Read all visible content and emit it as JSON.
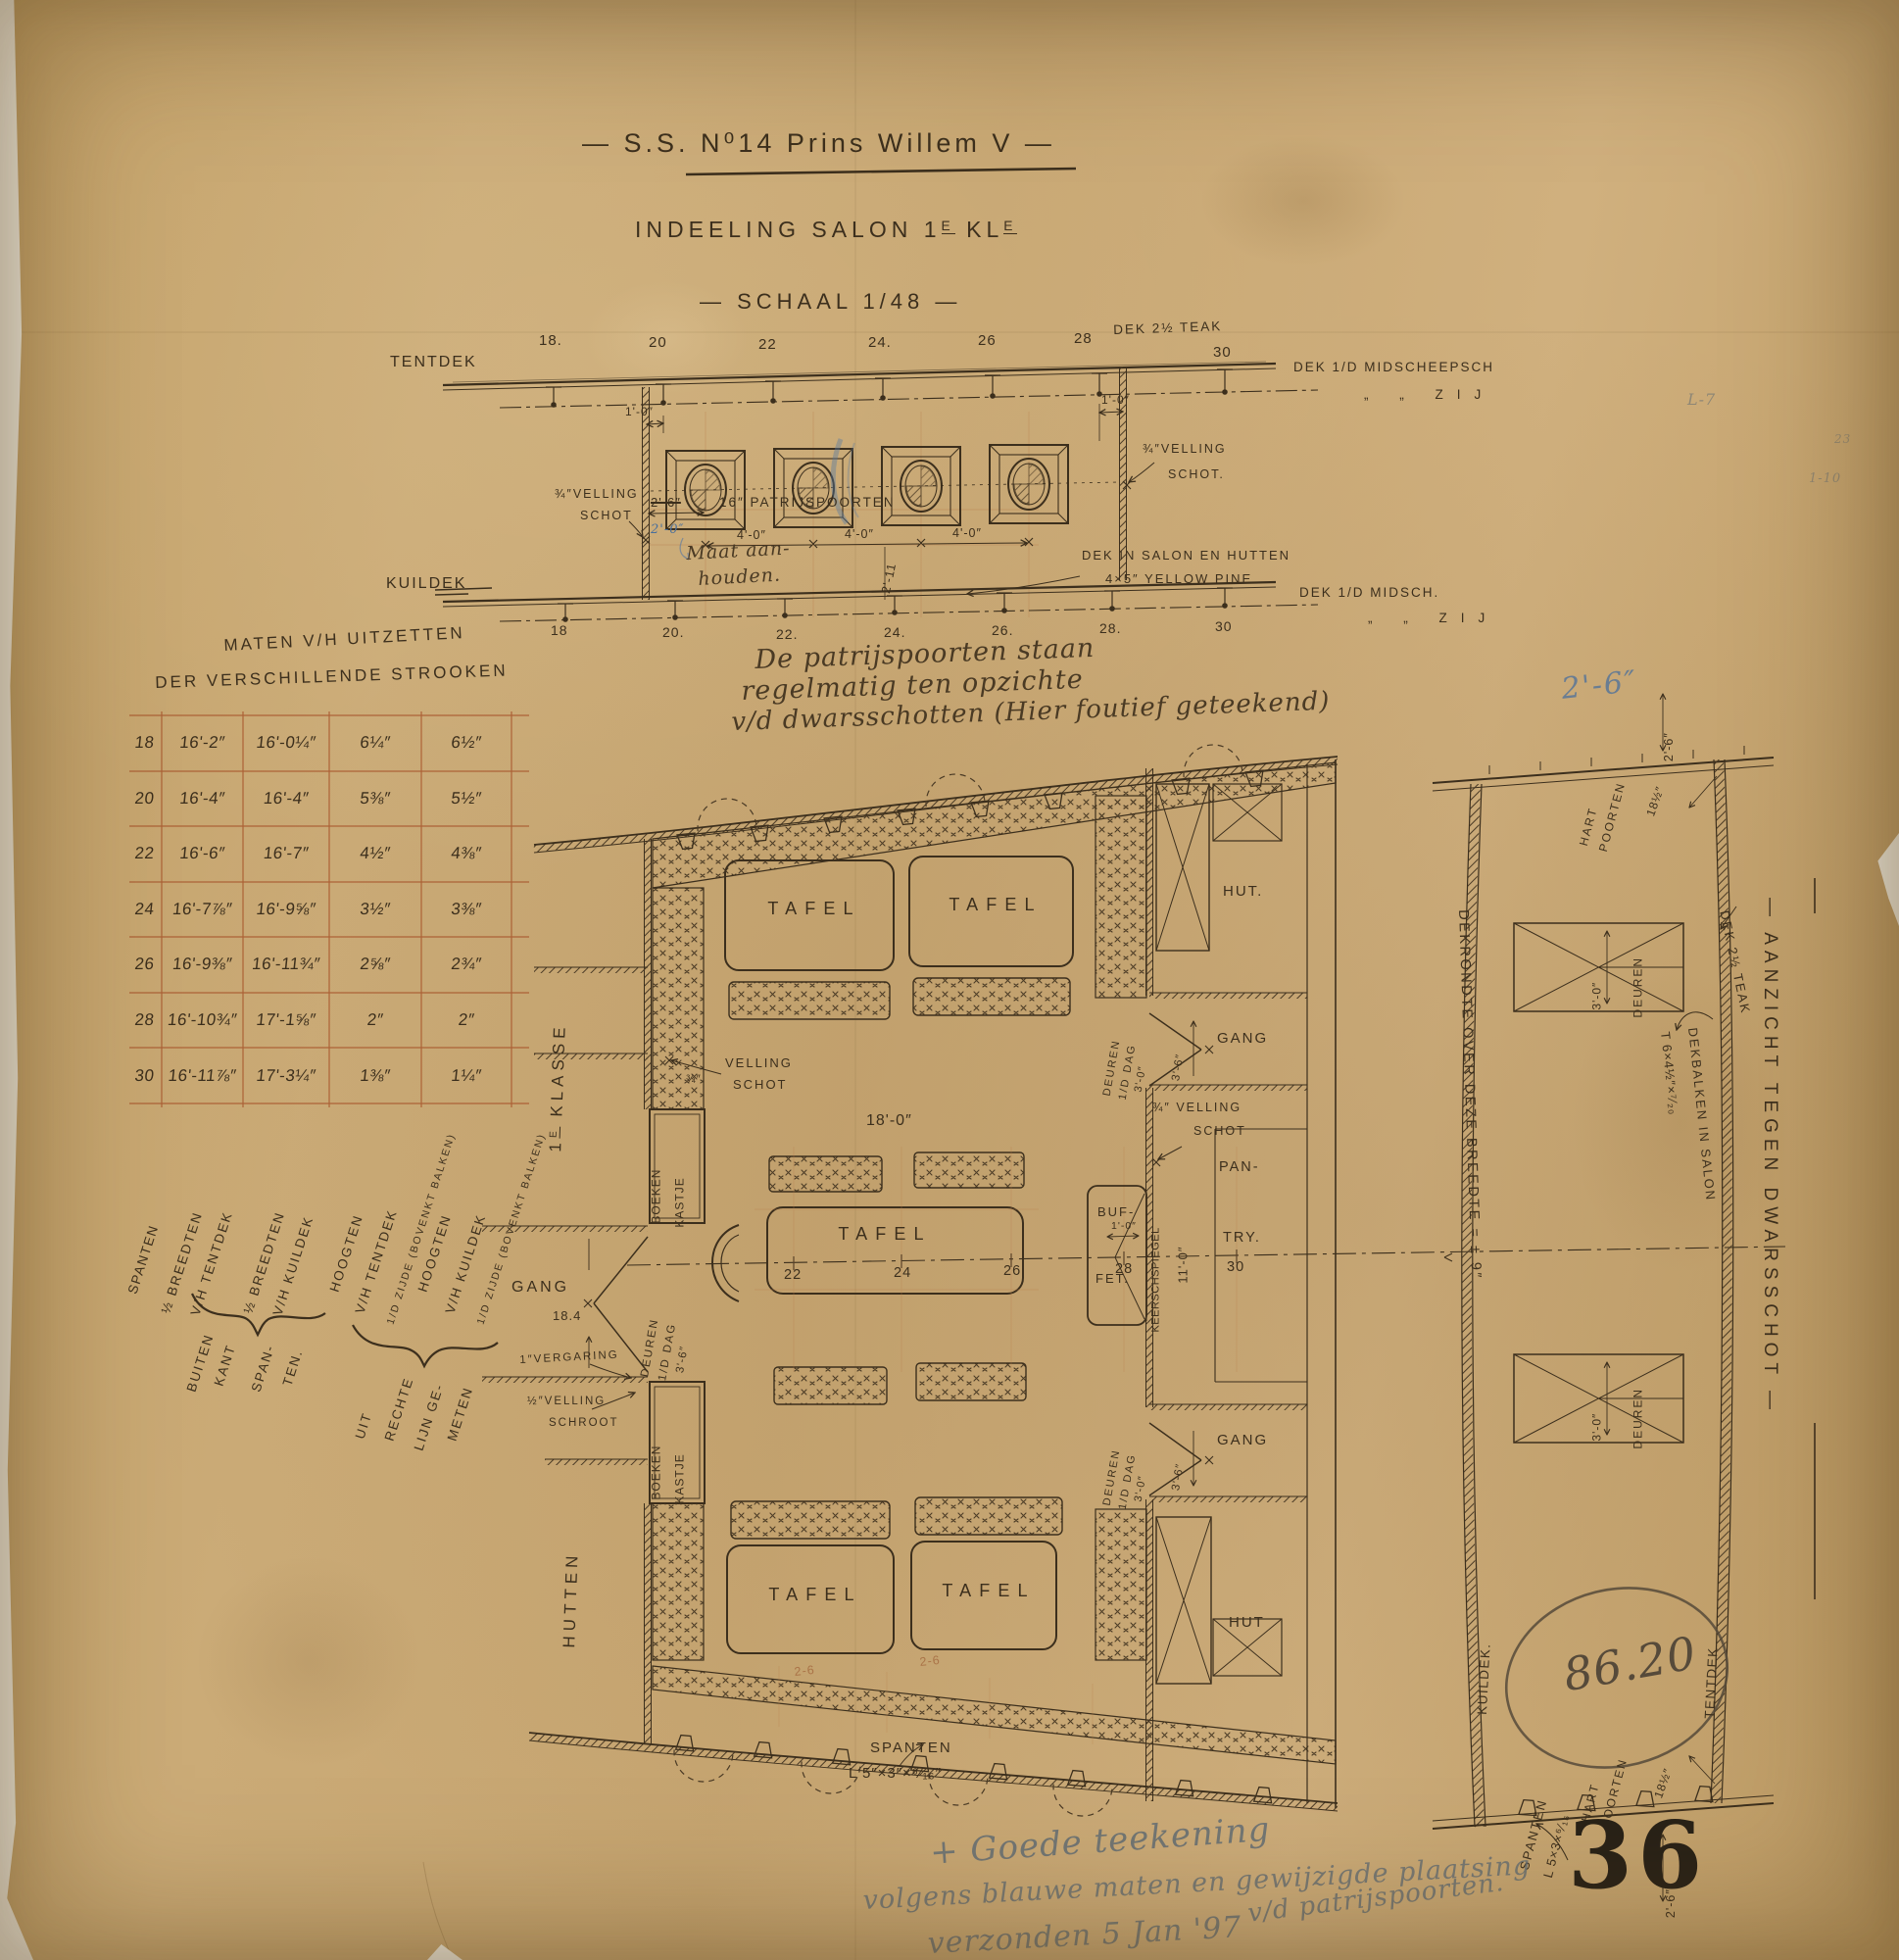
{
  "title": {
    "main": "— S.S. N⁰14 Prins Willem V —",
    "sub_pre": "INDEELING SALON 1",
    "sub_sup1": "E",
    "sub_mid": " KL",
    "sub_sup2": "E",
    "scale": "— SCHAAL 1/48 —"
  },
  "upper": {
    "tentdek": "TENTDEK",
    "kuildek": "KUILDEK",
    "ft": [
      "18.",
      "20",
      "22",
      "24.",
      "26",
      "28",
      "30"
    ],
    "fb": [
      "18",
      "20.",
      "22.",
      "24.",
      "26.",
      "28.",
      "30"
    ],
    "dek_teak": "DEK 2½ TEAK",
    "midscheepsch": "DEK 1/D MIDSCHEEPSCH",
    "zij1": "„ „ ZIJ",
    "midsch": "DEK 1/D MIDSCH.",
    "zij2": "„ „ ZIJ",
    "d10": "1'-0″",
    "d10b": "1'-0″",
    "d26": "2'-6″",
    "d20": "2'-0″",
    "pp": "16″ PATRIJSPOORTEN",
    "d40a": "4'-0″",
    "d40b": "4'-0″",
    "d40c": "4'-0″",
    "maat1": "Maat aan-",
    "maat2": "houden.",
    "vl1": "¾″VELLING",
    "vl2": "SCHOT",
    "vr1": "¾″VELLING",
    "vr2": "SCHOT.",
    "ds1": "DEK IN SALON EN HUTTEN",
    "ds2": "4×5″ YELLOW PINE",
    "p211": "2'-11"
  },
  "note": {
    "l1": "De patrijspoorten staan",
    "l2": "regelmatig ten opzichte",
    "l3": "v/d dwarsschotten (Hier foutief geteekend)"
  },
  "table": {
    "h1": "MATEN V/H UITZETTEN",
    "h2": "DER VERSCHILLENDE STROOKEN",
    "rows": [
      [
        "18",
        "16'-2″",
        "16'-0¼″",
        "6¼″",
        "6½″"
      ],
      [
        "20",
        "16'-4″",
        "16'-4″",
        "5⅜″",
        "5½″"
      ],
      [
        "22",
        "16'-6″",
        "16'-7″",
        "4½″",
        "4⅜″"
      ],
      [
        "24",
        "16'-7⅞″",
        "16'-9⅝″",
        "3½″",
        "3⅜″"
      ],
      [
        "26",
        "16'-9⅜″",
        "16'-11¾″",
        "2⅝″",
        "2¾″"
      ],
      [
        "28",
        "16'-10¾″",
        "17'-1⅝″",
        "2″",
        "2″"
      ],
      [
        "30",
        "16'-11⅞″",
        "17'-3¼″",
        "1⅜″",
        "1¼″"
      ]
    ],
    "c0": "SPANTEN",
    "c1a": "½ BREEDTEN",
    "c1b": "V/H TENTDEK",
    "c2a": "½ BREEDTEN",
    "c2b": "V/H KUILDEK",
    "c3a": "HOOGTEN",
    "c3b": "V/H TENTDEK",
    "c3c": "1/D ZIJDE (BOVENKT BALKEN)",
    "c4a": "HOOGTEN",
    "c4b": "V/H KUILDEK",
    "c4c": "1/D ZIJDE (BOVENKT BALKEN)",
    "b1": [
      "BUITEN",
      "KANT",
      "SPAN-",
      "TEN."
    ],
    "b2": [
      "UIT",
      "RECHTE",
      "LIJN GE-",
      "METEN"
    ]
  },
  "plan": {
    "klasse_pre": "1",
    "klasse_sup": "E",
    "klasse_post": " KLASSE",
    "hutten": "HUTTEN",
    "gang": "GANG",
    "gang_dim": "18.4",
    "vs_frac": "¾″",
    "vs1": "VELLING",
    "vs2": "SCHOT",
    "boeken": "BOEKEN",
    "kastje": "KASTJE",
    "dl1": "DEUREN",
    "dl2": "1/D DAG",
    "dl3": "3'-6″",
    "verg": "1″VERGARING",
    "schroot1": "½″VELLING",
    "schroot2": "SCHROOT",
    "d180": "18'-0″",
    "tafel": "TAFEL",
    "cf": [
      "22",
      "24",
      "26",
      "28",
      "30"
    ],
    "buf": "BUF-",
    "fet": "FET.",
    "d10": "1'-0″",
    "spiegel": "KEERSCHSPIEGEL",
    "d110": "11'-0″",
    "pan": "PAN-",
    "try": "TRY.",
    "vr1": "¾″ VELLING",
    "vr2": "SCHOT",
    "hut1": "HUT.",
    "hut2": "HUT",
    "gang_r1": "GANG",
    "gang_r2": "GANG",
    "dr1": "DEUREN",
    "dr2": "1/D DAG",
    "dr3": "3'-0″",
    "d36": "3'-6″",
    "sp1": "SPANTEN",
    "sp2": "L 5″×3″×⁶⁄₁₆″",
    "p26": "2-6"
  },
  "section": {
    "p26": "2'-6″",
    "d26t": "2'-6″",
    "d26b": "2'-6″",
    "hart": "HART",
    "poorten": "POORTEN",
    "d185": "18½″",
    "teak": "DEK 2½ TEAK",
    "deuren": "DEUREN",
    "d30": "3'-0″",
    "rondte": "DEKRONDTE OVER DEZE BREEDTE = ± 9″",
    "balken": "DEKBALKEN IN SALON",
    "tprof": "T 6×4½″×⁷⁄₂₀",
    "kuildek": "KUILDEK.",
    "tentdek": "TENTDEK",
    "sp1": "SPANTEN",
    "sp2": "L 5×3×⁶⁄₁₆",
    "aanzicht": "— AANZICHT TEGEN DWARSSCHOT —"
  },
  "annots": {
    "oval": "86.20",
    "stamp": "36",
    "p1": "+ Goede teekening",
    "p2": "volgens blauwe maten en gewijzigde plaatsing",
    "p3": "verzonden 5 Jan '97",
    "p4": "v/d patrijspoorten.",
    "s1": "L-7",
    "s2": "23",
    "s3": "1-10"
  }
}
